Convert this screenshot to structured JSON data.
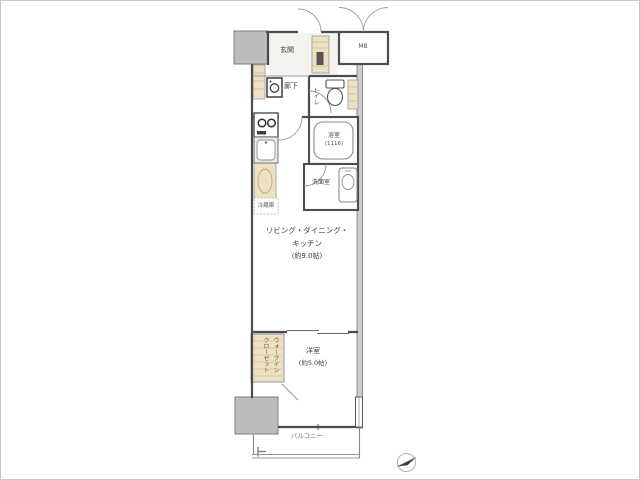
{
  "floor_plan": {
    "entrance": {
      "label": "玄関"
    },
    "meter_box": {
      "label": "MB"
    },
    "hallway": {
      "label": "廊下"
    },
    "toilet": {
      "label": "トイレ"
    },
    "bathroom": {
      "label": "浴室",
      "size": "(1116)"
    },
    "washroom": {
      "label": "洗面室"
    },
    "kitchen": {
      "refrigerator_label": "冷蔵庫"
    },
    "ldk": {
      "label_line1": "リビング・ダイニング・",
      "label_line2": "キッチン",
      "size": "(約9.0帖)"
    },
    "bedroom": {
      "label": "洋室",
      "size": "(約5.0帖)"
    },
    "closet": {
      "label_right_column": "ウォークイン",
      "label_left_column": "クローゼット"
    },
    "balcony": {
      "label": "バルコニー"
    },
    "icons": {
      "compass": "north-compass-icon",
      "toilet": "toilet-icon",
      "bathtub": "bathtub-icon",
      "washbasin": "washbasin-icon",
      "washing_machine": "washing-machine-icon",
      "cooktop": "cooktop-icon",
      "kitchen_sink": "kitchen-sink-icon"
    },
    "colors": {
      "wall": "#4c4c4f",
      "pillar": "#bcbcbe",
      "fixture_tan": "#ece1c2",
      "door_arc": "#9a9a9d",
      "background": "#ffffff",
      "border": "#c9c9c9"
    }
  }
}
